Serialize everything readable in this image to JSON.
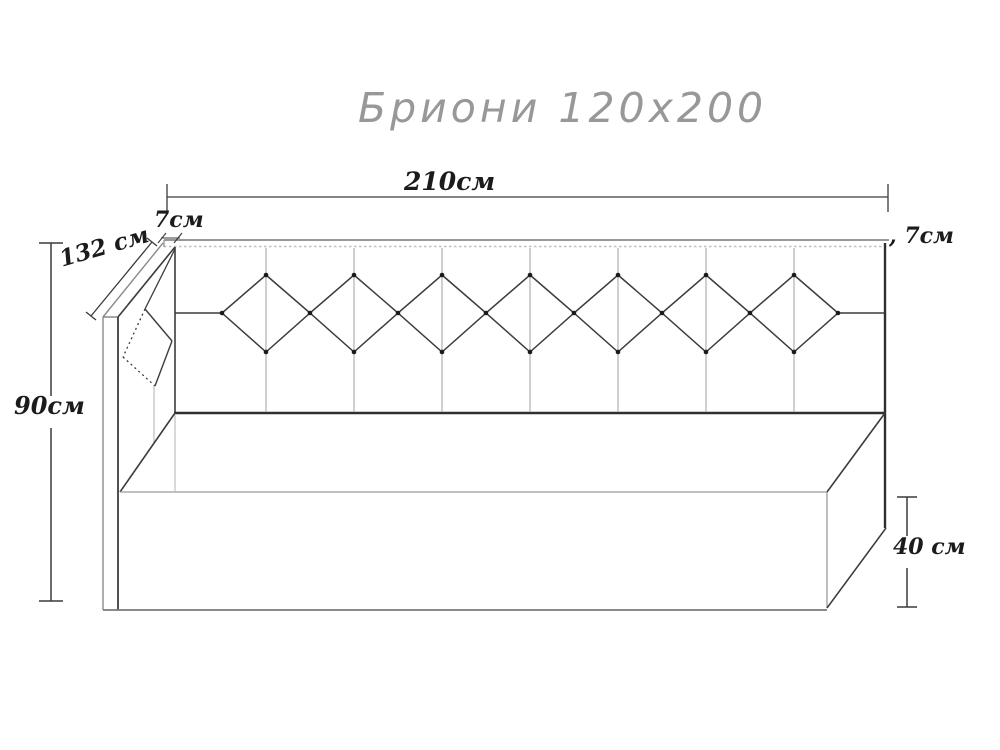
{
  "title": "Бриони 120x200",
  "product": {
    "name": "Бриони",
    "mattress_size": "120x200"
  },
  "dimensions": {
    "total_width": "210см",
    "left_panel_thickness": "7см",
    "right_panel_thickness": ", 7см",
    "side_backrest_length": "132 см",
    "total_height": "90см",
    "base_height": "40 см"
  },
  "colors": {
    "line_dark": "#2f2f2f",
    "line_medium": "#3c3c3c",
    "line_light": "#9a9a9a",
    "hidden_line": "#b8b8b8",
    "title_gray": "#8d8d8d",
    "background": "#ffffff"
  }
}
